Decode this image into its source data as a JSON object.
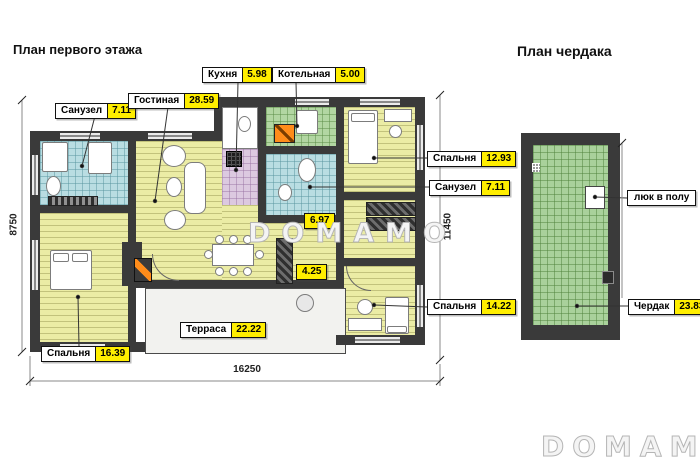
{
  "first_floor": {
    "title": "План первого этажа",
    "rooms": {
      "sanuzel1": {
        "name": "Санузел",
        "area": "7.11"
      },
      "gostinaya": {
        "name": "Гостиная",
        "area": "28.59"
      },
      "kuhnya": {
        "name": "Кухня",
        "area": "5.98"
      },
      "kotelnaya": {
        "name": "Котельная",
        "area": "5.00"
      },
      "spalnya_top": {
        "name": "Спальня",
        "area": "12.93"
      },
      "sanuzel2": {
        "name": "Санузел",
        "area": "7.11"
      },
      "hall": {
        "area": "6.97"
      },
      "corridor": {
        "area": "4.25"
      },
      "spalnya_right": {
        "name": "Спальня",
        "area": "14.22"
      },
      "spalnya_left": {
        "name": "Спальня",
        "area": "16.39"
      },
      "terrasa": {
        "name": "Терраса",
        "area": "22.22"
      }
    },
    "dimensions": {
      "left": "8750",
      "right": "11450",
      "bottom": "16250"
    }
  },
  "attic": {
    "title": "План чердака",
    "rooms": {
      "hatch": {
        "name": "люк в полу"
      },
      "cherdak": {
        "name": "Чердак",
        "area": "23.83"
      }
    }
  },
  "watermark": {
    "center": "DOMAMO",
    "corner": "DOMAMO"
  },
  "colors": {
    "wall": "#3a3a3a",
    "area_badge": "#ffee00",
    "floor_wood": "#ebeca5",
    "tile_blue": "#b9dde2",
    "tile_green": "#b2d6a2",
    "tile_purple": "#dcc9e0",
    "attic_green": "#a9d19b",
    "accent_orange": "#ff8c1a"
  }
}
